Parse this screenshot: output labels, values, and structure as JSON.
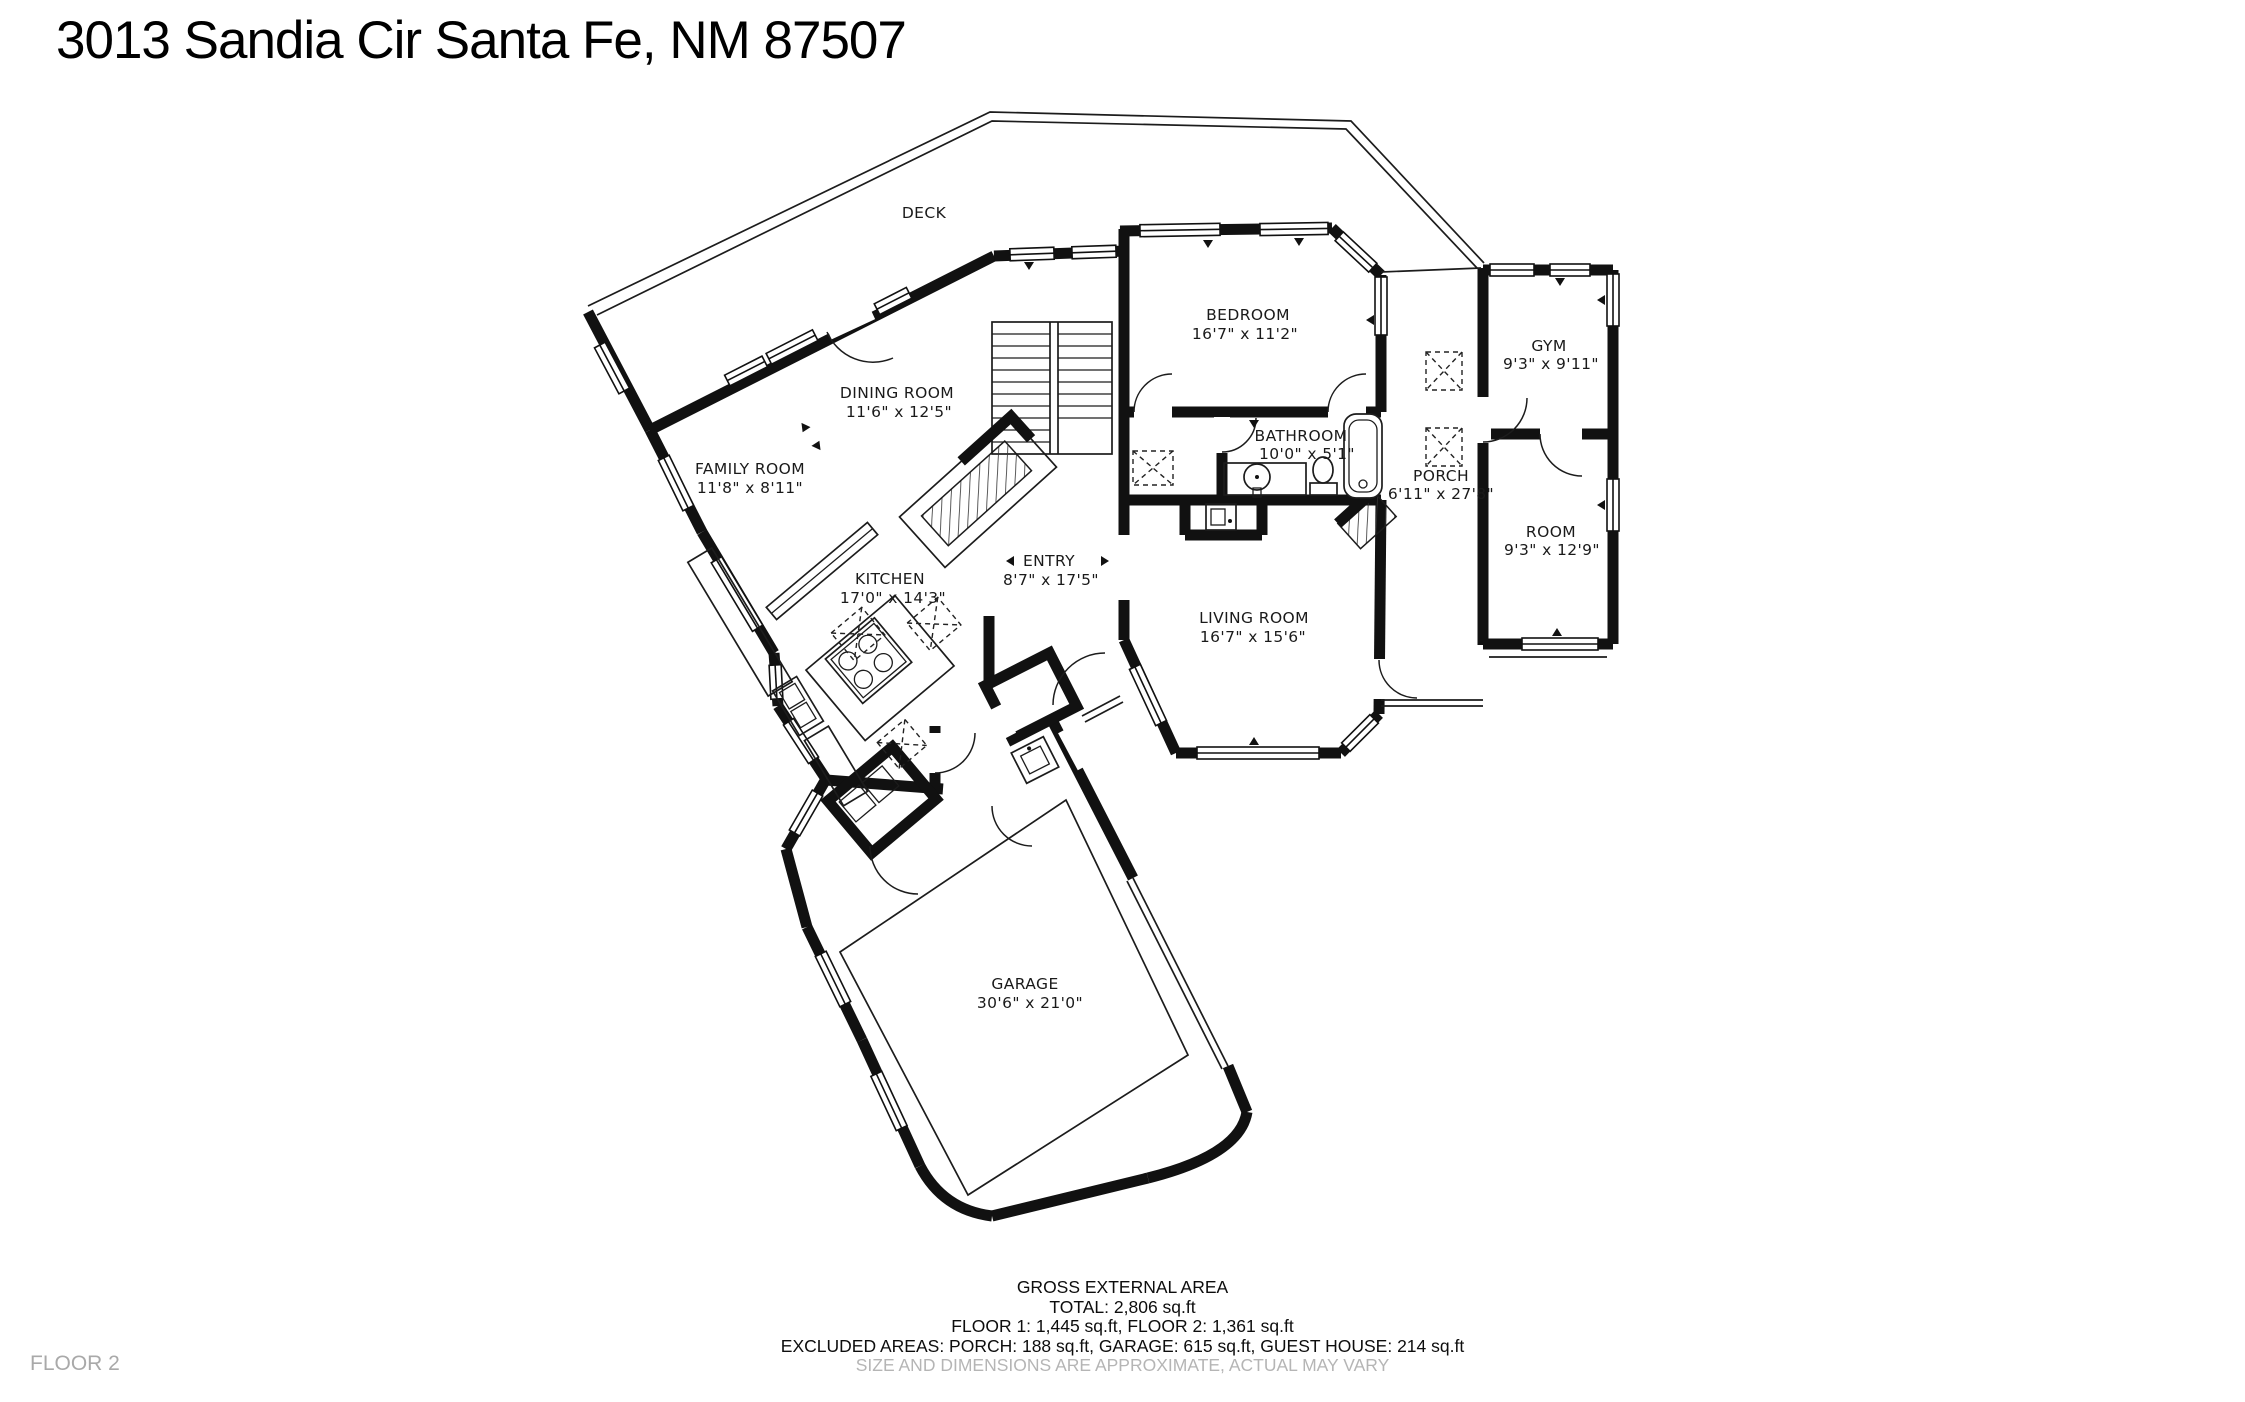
{
  "title": "3013 Sandia Cir Santa Fe, NM 87507",
  "floor_label": "FLOOR 2",
  "rooms": {
    "deck": {
      "name": "DECK",
      "dims": ""
    },
    "family_room": {
      "name": "FAMILY ROOM",
      "dims": "11'8\" x 8'11\""
    },
    "dining_room": {
      "name": "DINING ROOM",
      "dims": "11'6\" x 12'5\""
    },
    "kitchen": {
      "name": "KITCHEN",
      "dims": "17'0\" x 14'3\""
    },
    "entry": {
      "name": "ENTRY",
      "dims": "8'7\" x 17'5\""
    },
    "living_room": {
      "name": "LIVING ROOM",
      "dims": "16'7\" x 15'6\""
    },
    "bedroom": {
      "name": "BEDROOM",
      "dims": "16'7\" x 11'2\""
    },
    "bathroom": {
      "name": "BATHROOM",
      "dims": "10'0\" x 5'1\""
    },
    "gym": {
      "name": "GYM",
      "dims": "9'3\" x 9'11\""
    },
    "porch": {
      "name": "PORCH",
      "dims": "6'11\" x 27'8\""
    },
    "room": {
      "name": "ROOM",
      "dims": "9'3\" x 12'9\""
    },
    "garage": {
      "name": "GARAGE",
      "dims": "30'6\" x 21'0\""
    }
  },
  "footer": {
    "heading": "GROSS EXTERNAL AREA",
    "total": "TOTAL: 2,806 sq.ft",
    "floors": "FLOOR 1: 1,445 sq.ft, FLOOR 2: 1,361 sq.ft",
    "excluded": "EXCLUDED AREAS: PORCH: 188 sq.ft, GARAGE: 615 sq.ft, GUEST HOUSE: 214 sq.ft",
    "disclaimer": "SIZE AND DIMENSIONS ARE APPROXIMATE, ACTUAL MAY VARY"
  },
  "colors": {
    "wall": "#111111",
    "muted": "#a9a9a9",
    "background": "#ffffff"
  }
}
